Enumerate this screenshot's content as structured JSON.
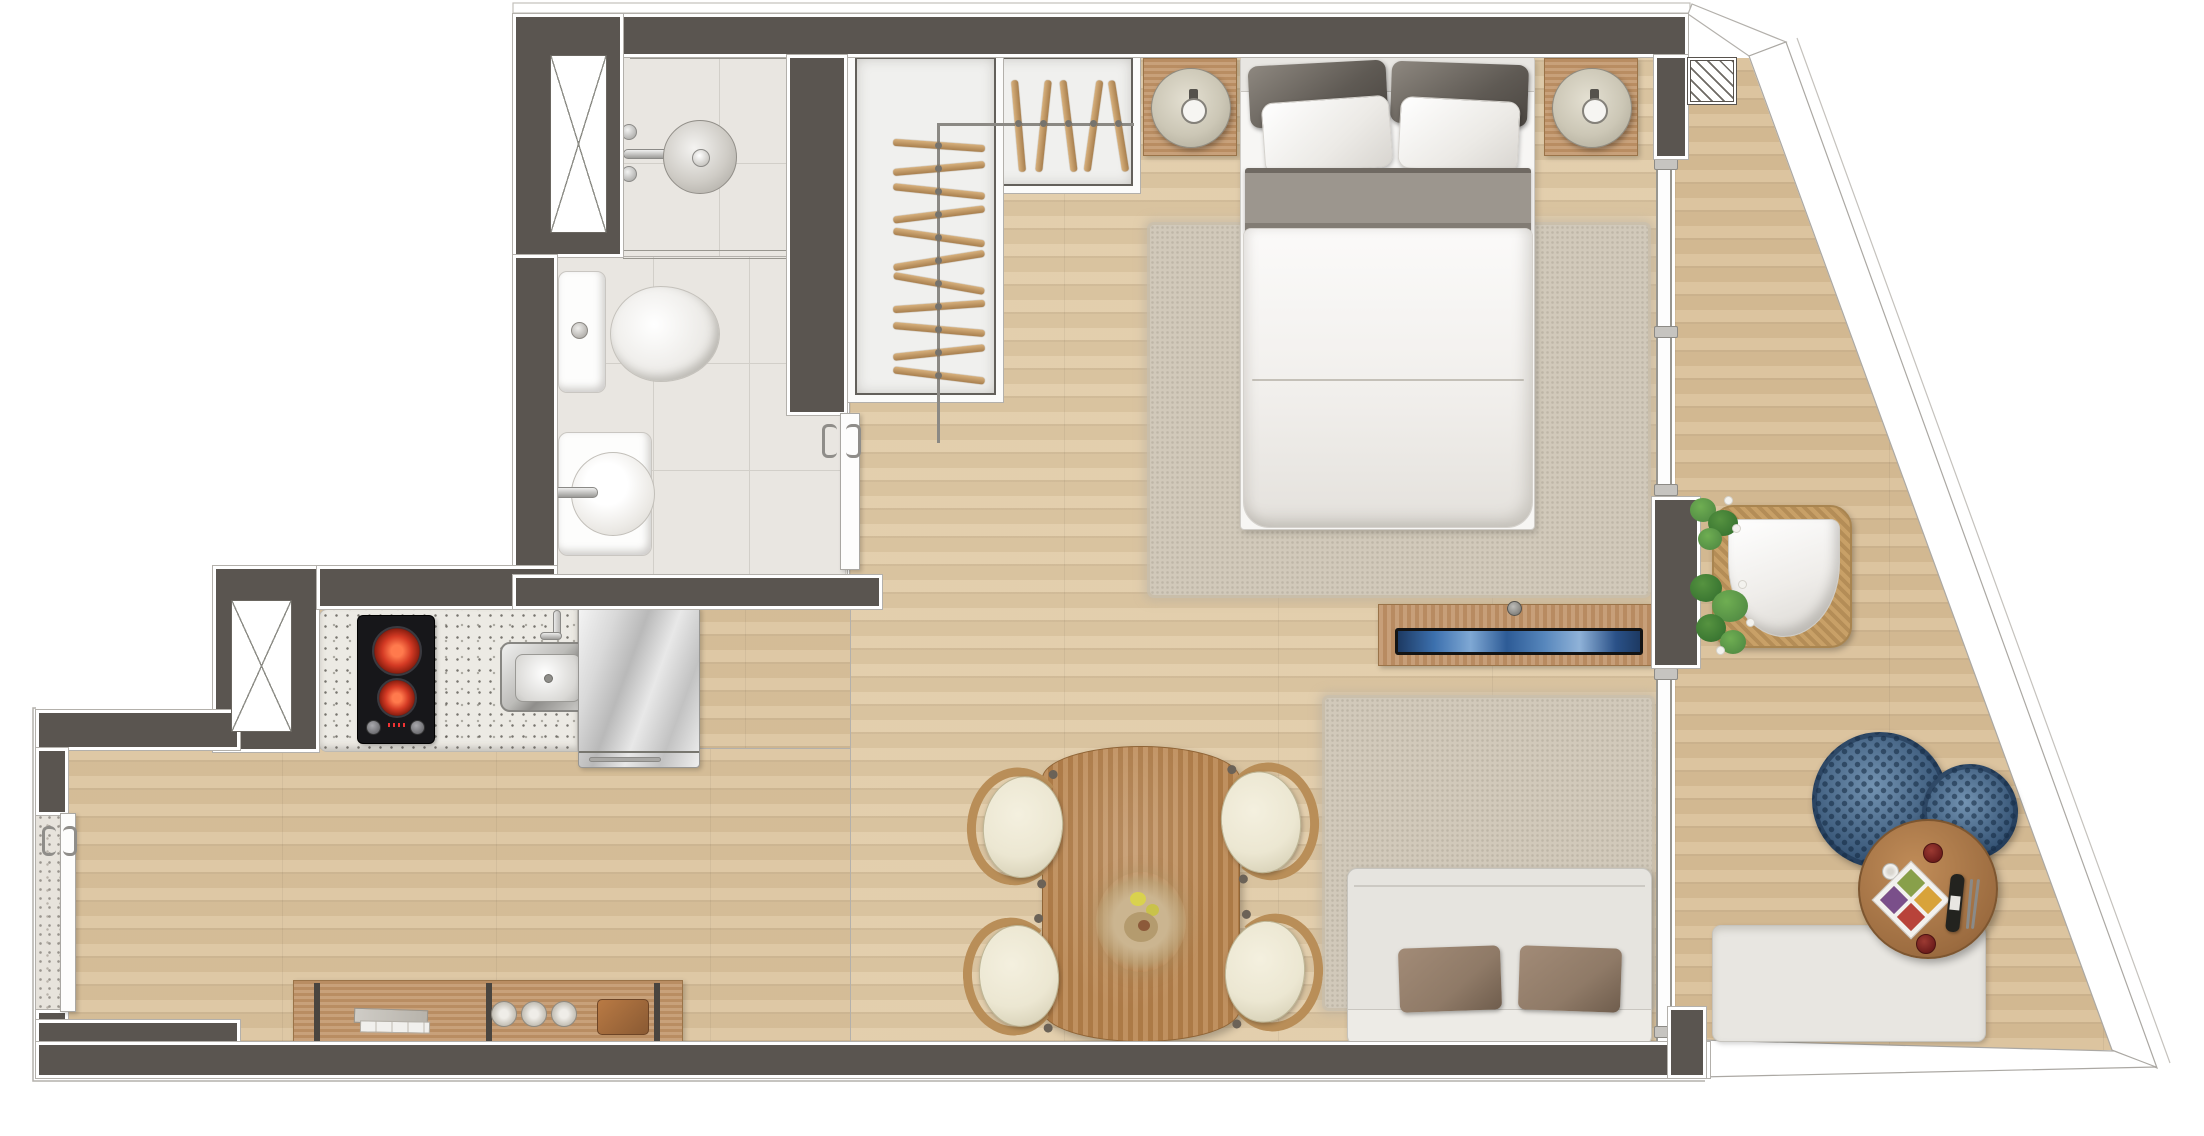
{
  "plan": {
    "kind": "studio-apartment-floor-plan",
    "view": "top-down-render",
    "text_labels": []
  },
  "palette": {
    "wall": "#5a5550",
    "outline": "#b3b0ab",
    "wood": "#dcc49e",
    "woodBalcony": "#d9bf98",
    "tile": "#e9e6e1",
    "tileLine": "#d2cfc9",
    "terrazzo": "#e7e3dc",
    "closet": "#f0f0ee",
    "rug": "#d1c9ba",
    "furnWood": "#c2966b",
    "tableWood": "#b9854f",
    "consoleWood": "#c1946a",
    "sofa": "#e6e4df",
    "sofaCushion": "#8f7a67",
    "bedWhite": "#f7f6f4",
    "sheetGray": "#9c968e",
    "poufBlue": "#46688c",
    "green": "#4a8340",
    "screenBlue": "#3c70ae",
    "chairSeat": "#ece7d2",
    "chairWood": "#b98e58",
    "burnerRed": "#d43a24",
    "hangerWood": "#c2996a",
    "glassLine": "#98968f",
    "lamp": "#ccc7b6",
    "wine": "#6e1d1c",
    "pot": "#8a5a33",
    "bottle": "#23231f",
    "bench": "#e8e6e1",
    "wicker": "#c8a067"
  },
  "counts": {
    "closet_hangers_top": 5,
    "closet_hangers_side": 11,
    "dining_chairs": 4,
    "decor_plates": 3,
    "poufs": 2,
    "stove_burners": 2,
    "glass_joints": 5,
    "bed_pillows": 4,
    "service_shafts": 2
  },
  "rooms": [
    {
      "id": "bathroom",
      "objects": [
        "shower-head",
        "shower-valves",
        "shower-glass",
        "toilet",
        "washbasin",
        "sliding-door"
      ]
    },
    {
      "id": "closet",
      "objects": [
        "wardrobe-rail",
        "clothes-hangers"
      ]
    },
    {
      "id": "bedroom",
      "objects": [
        "double-bed",
        "nightstand-left",
        "table-lamp-left",
        "nightstand-right",
        "table-lamp-right",
        "area-rug"
      ]
    },
    {
      "id": "kitchen",
      "objects": [
        "granite-countertop",
        "two-burner-cooktop",
        "sink",
        "refrigerator",
        "service-shaft"
      ]
    },
    {
      "id": "living-dining",
      "objects": [
        "dining-table",
        "dining-chairs",
        "flower-centerpiece",
        "sideboard",
        "decor-plates",
        "books",
        "potted-plant",
        "sofa",
        "sofa-cushions",
        "area-rug",
        "tv-console",
        "tv"
      ]
    },
    {
      "id": "balcony",
      "objects": [
        "rattan-armchair",
        "potted-plants",
        "woven-poufs",
        "round-table",
        "serving-tray",
        "wine-bottle",
        "candle",
        "bench",
        "glass-sliding-wall",
        "hatched-column"
      ]
    }
  ]
}
